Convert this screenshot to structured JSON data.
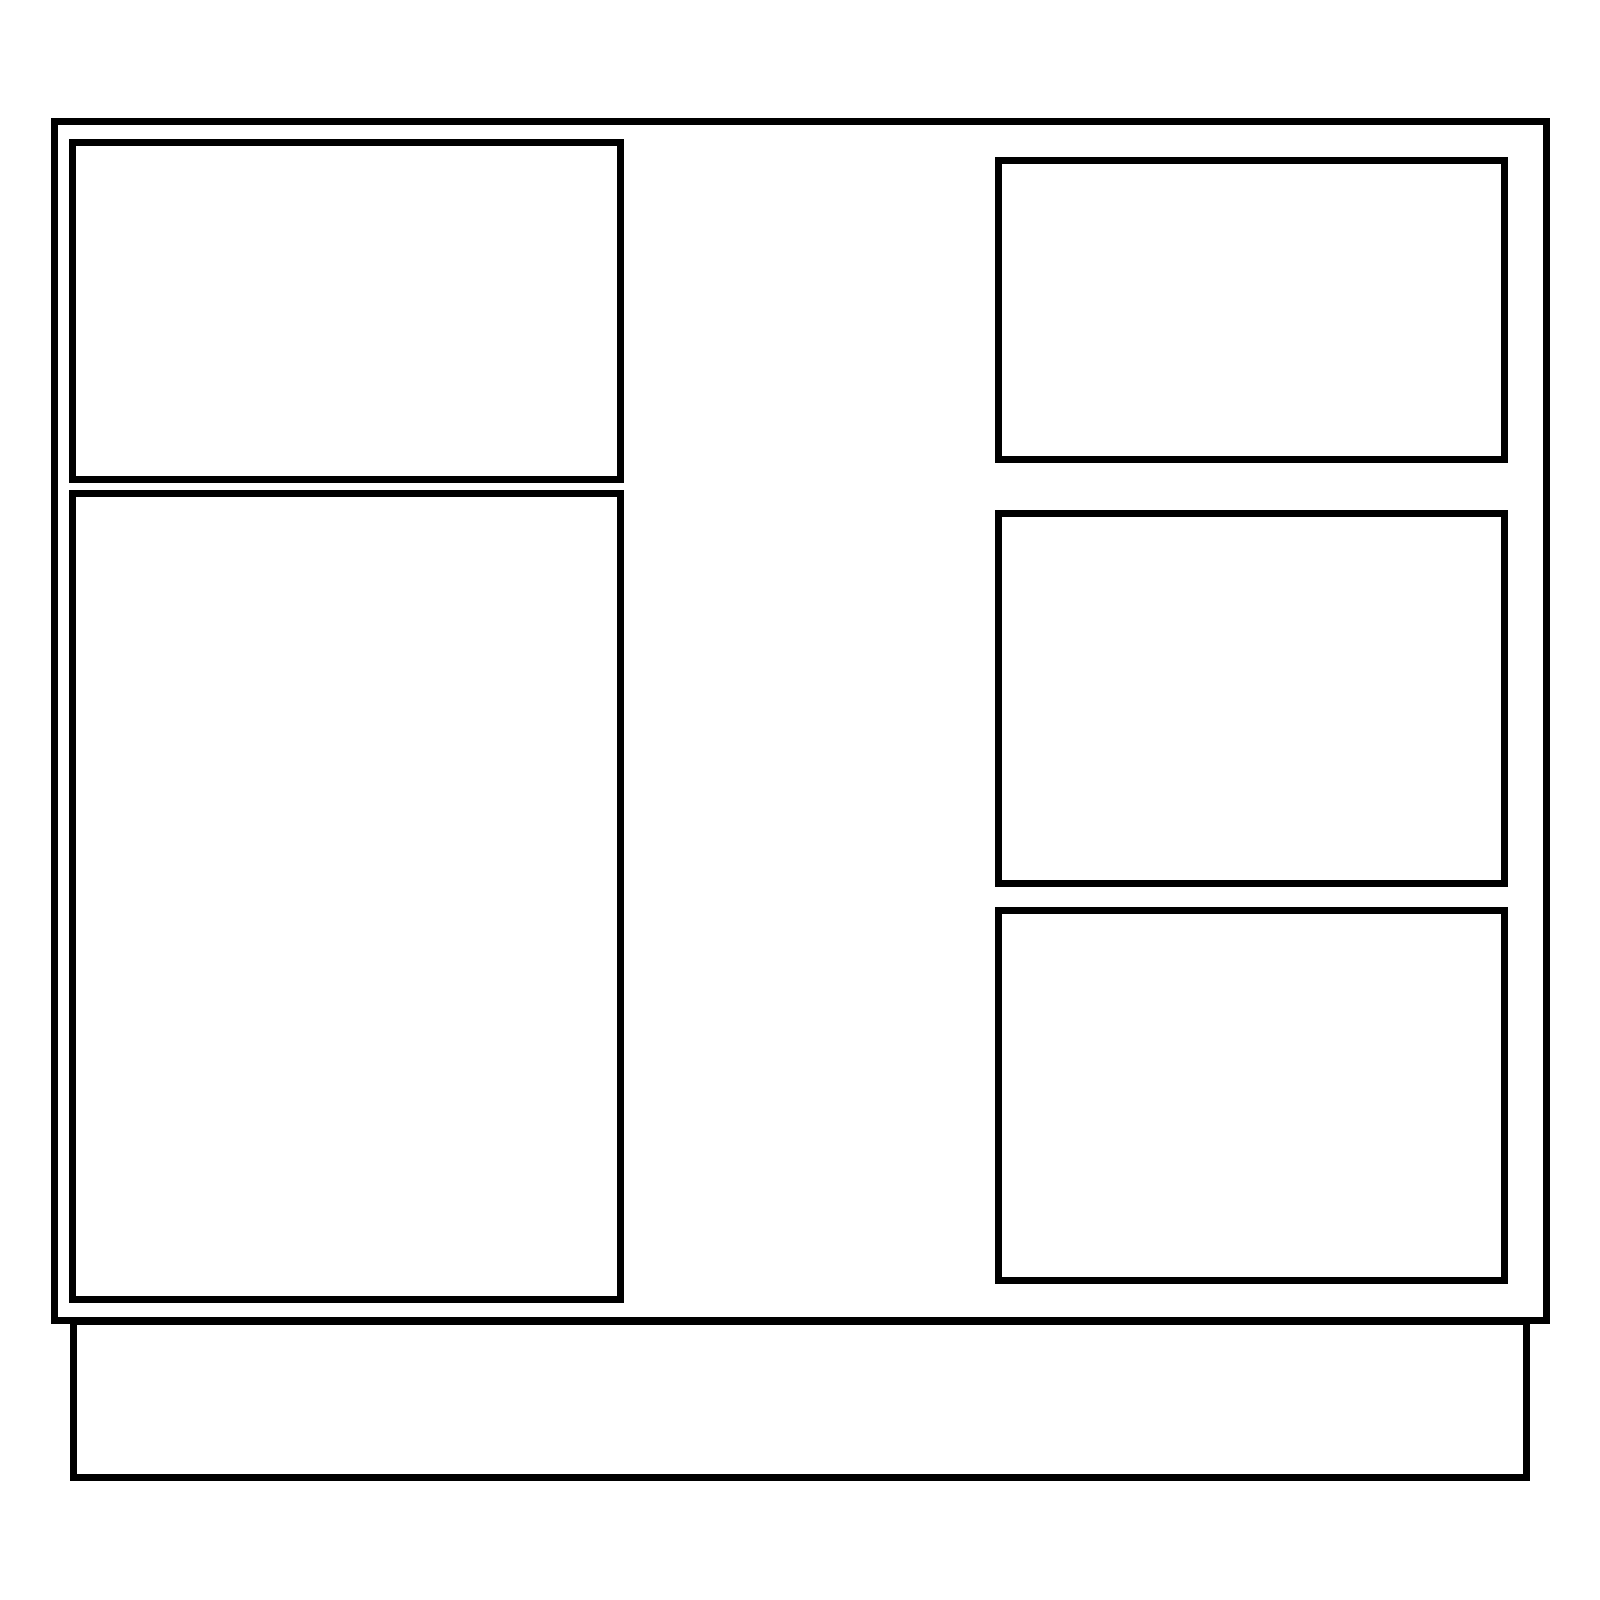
{
  "canvas": {
    "width": 1600,
    "height": 1600,
    "background_color": "#ffffff"
  },
  "stroke": {
    "color": "#000000",
    "width_px": 7
  },
  "drawing": {
    "kind": "cabinet-elevation-line-drawing",
    "shapes": [
      {
        "name": "cabinet-body-outline",
        "x": 51,
        "y": 118,
        "width": 1499,
        "height": 1206
      },
      {
        "name": "plinth-base-outline",
        "x": 70,
        "y": 1318,
        "width": 1460,
        "height": 163
      },
      {
        "name": "left-drawer-front-panel",
        "x": 69,
        "y": 139,
        "width": 555,
        "height": 344
      },
      {
        "name": "left-door-panel",
        "x": 69,
        "y": 490,
        "width": 555,
        "height": 813
      },
      {
        "name": "right-top-drawer-panel",
        "x": 995,
        "y": 157,
        "width": 513,
        "height": 306
      },
      {
        "name": "right-middle-drawer-panel",
        "x": 995,
        "y": 510,
        "width": 513,
        "height": 377
      },
      {
        "name": "right-bottom-drawer-panel",
        "x": 995,
        "y": 907,
        "width": 513,
        "height": 377
      }
    ]
  }
}
